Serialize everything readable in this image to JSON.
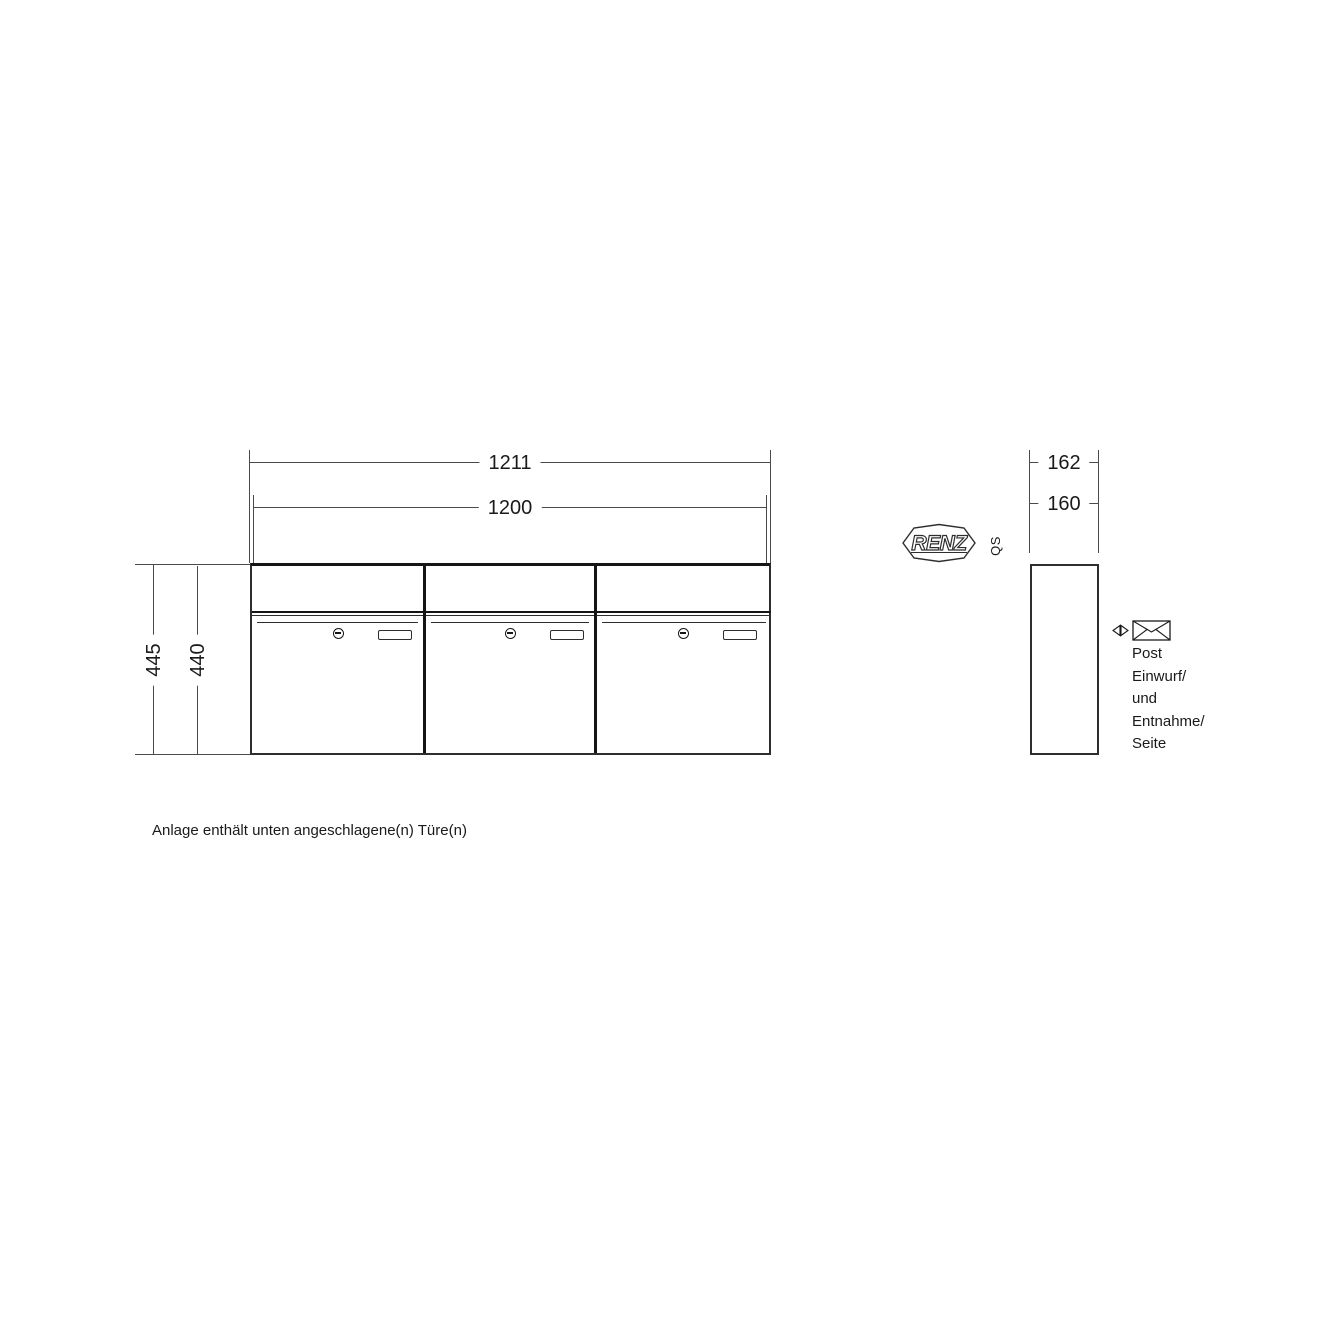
{
  "front_view": {
    "width_outer": "1211",
    "width_inner": "1200",
    "height_outer": "445",
    "height_inner": "440"
  },
  "side_view": {
    "depth_outer": "162",
    "depth_inner": "160"
  },
  "brand": {
    "logo_text": "RENZ",
    "qs_label": "QS"
  },
  "post_note": {
    "lines": [
      "Post",
      "Einwurf/",
      "und",
      "Entnahme/",
      "Seite"
    ]
  },
  "footer": {
    "note": "Anlage enthält unten angeschlagene(n) Türe(n)"
  },
  "colors": {
    "dimension_line": "#4a4a4a",
    "outline": "#151515",
    "background": "#ffffff"
  }
}
